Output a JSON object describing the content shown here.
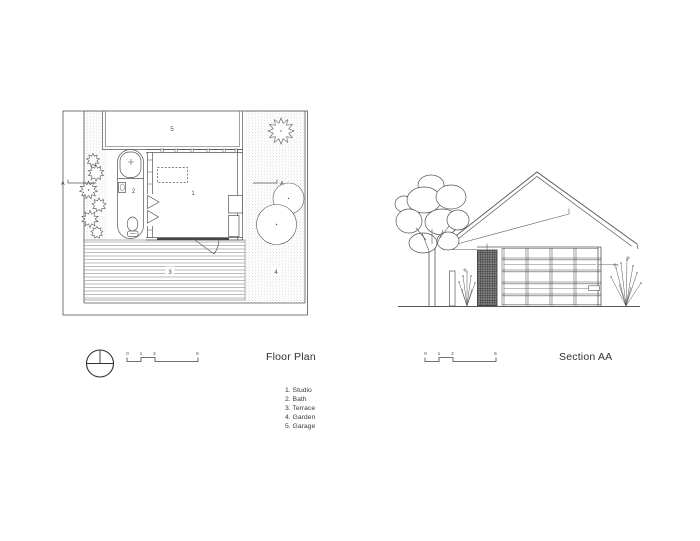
{
  "floor_plan": {
    "title": "Floor Plan",
    "room_labels": {
      "studio": "1",
      "bath": "2",
      "terrace": "3",
      "garden": "4",
      "garage": "5"
    },
    "section_marker_left": "A",
    "section_marker_right": "A",
    "scale_bar": {
      "ticks": [
        "0",
        "1",
        "2",
        "5"
      ]
    }
  },
  "section": {
    "title": "Section AA",
    "scale_bar": {
      "ticks": [
        "0",
        "1",
        "2",
        "5"
      ]
    }
  },
  "legend": {
    "items": [
      "1. Studio",
      "2. Bath",
      "3. Terrace",
      "4. Garden",
      "5. Garage"
    ]
  },
  "colors": {
    "line": "#4d4d4d",
    "dark_line": "#333333",
    "stipple": "#bbbbbb",
    "background": "#ffffff"
  }
}
